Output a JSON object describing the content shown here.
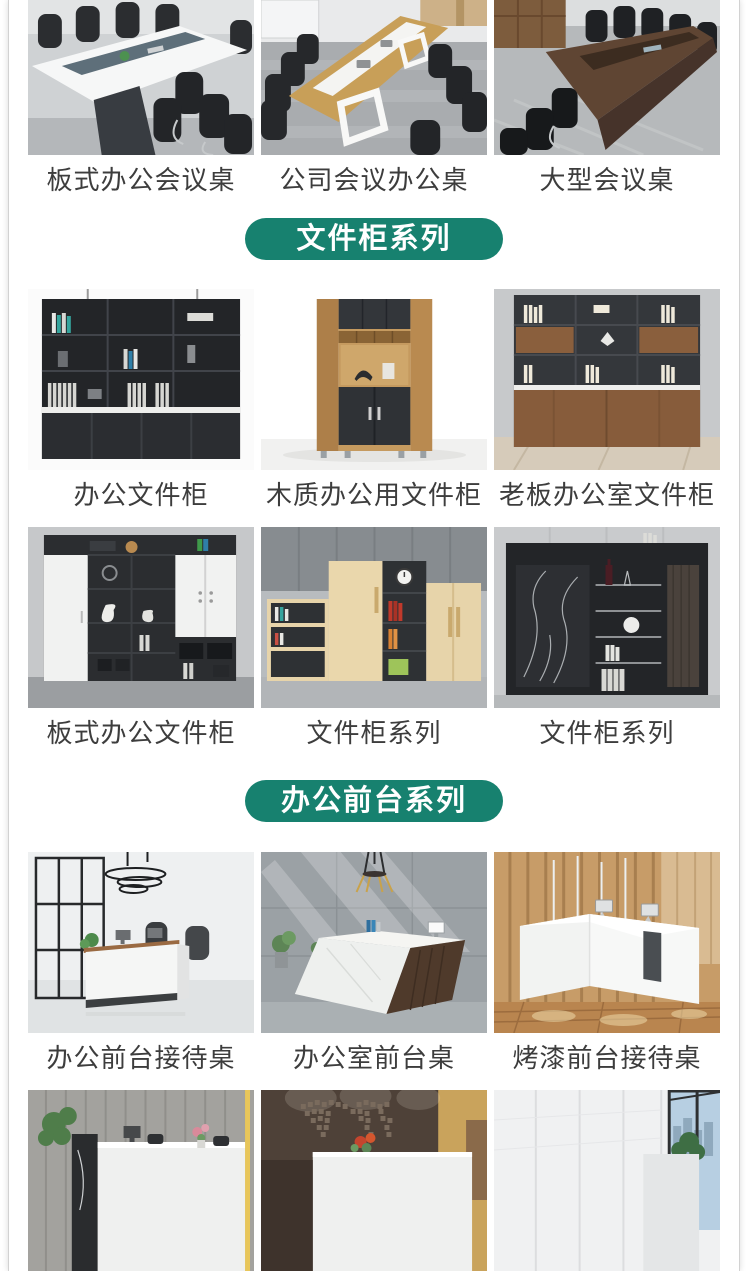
{
  "theme": {
    "accent_green": "#17816f",
    "pill_text_color": "#ffffff",
    "label_color": "#3d3d3d",
    "frame_border": "#d2d2d2",
    "page_bg": "#ffffff"
  },
  "section_headers": {
    "cabinet_series": "文件柜系列",
    "reception_series": "办公前台系列"
  },
  "rows": [
    {
      "items": [
        {
          "label": "板式办公会议桌"
        },
        {
          "label": "公司会议办公桌"
        },
        {
          "label": "大型会议桌"
        }
      ]
    },
    {
      "items": [
        {
          "label": "办公文件柜"
        },
        {
          "label": "木质办公用文件柜"
        },
        {
          "label": "老板办公室文件柜"
        }
      ]
    },
    {
      "items": [
        {
          "label": "板式办公文件柜"
        },
        {
          "label": "文件柜系列"
        },
        {
          "label": "文件柜系列"
        }
      ]
    },
    {
      "items": [
        {
          "label": "办公前台接待桌"
        },
        {
          "label": "办公室前台桌"
        },
        {
          "label": "烤漆前台接待桌"
        }
      ]
    },
    {
      "items": [
        {},
        {},
        {}
      ]
    }
  ]
}
